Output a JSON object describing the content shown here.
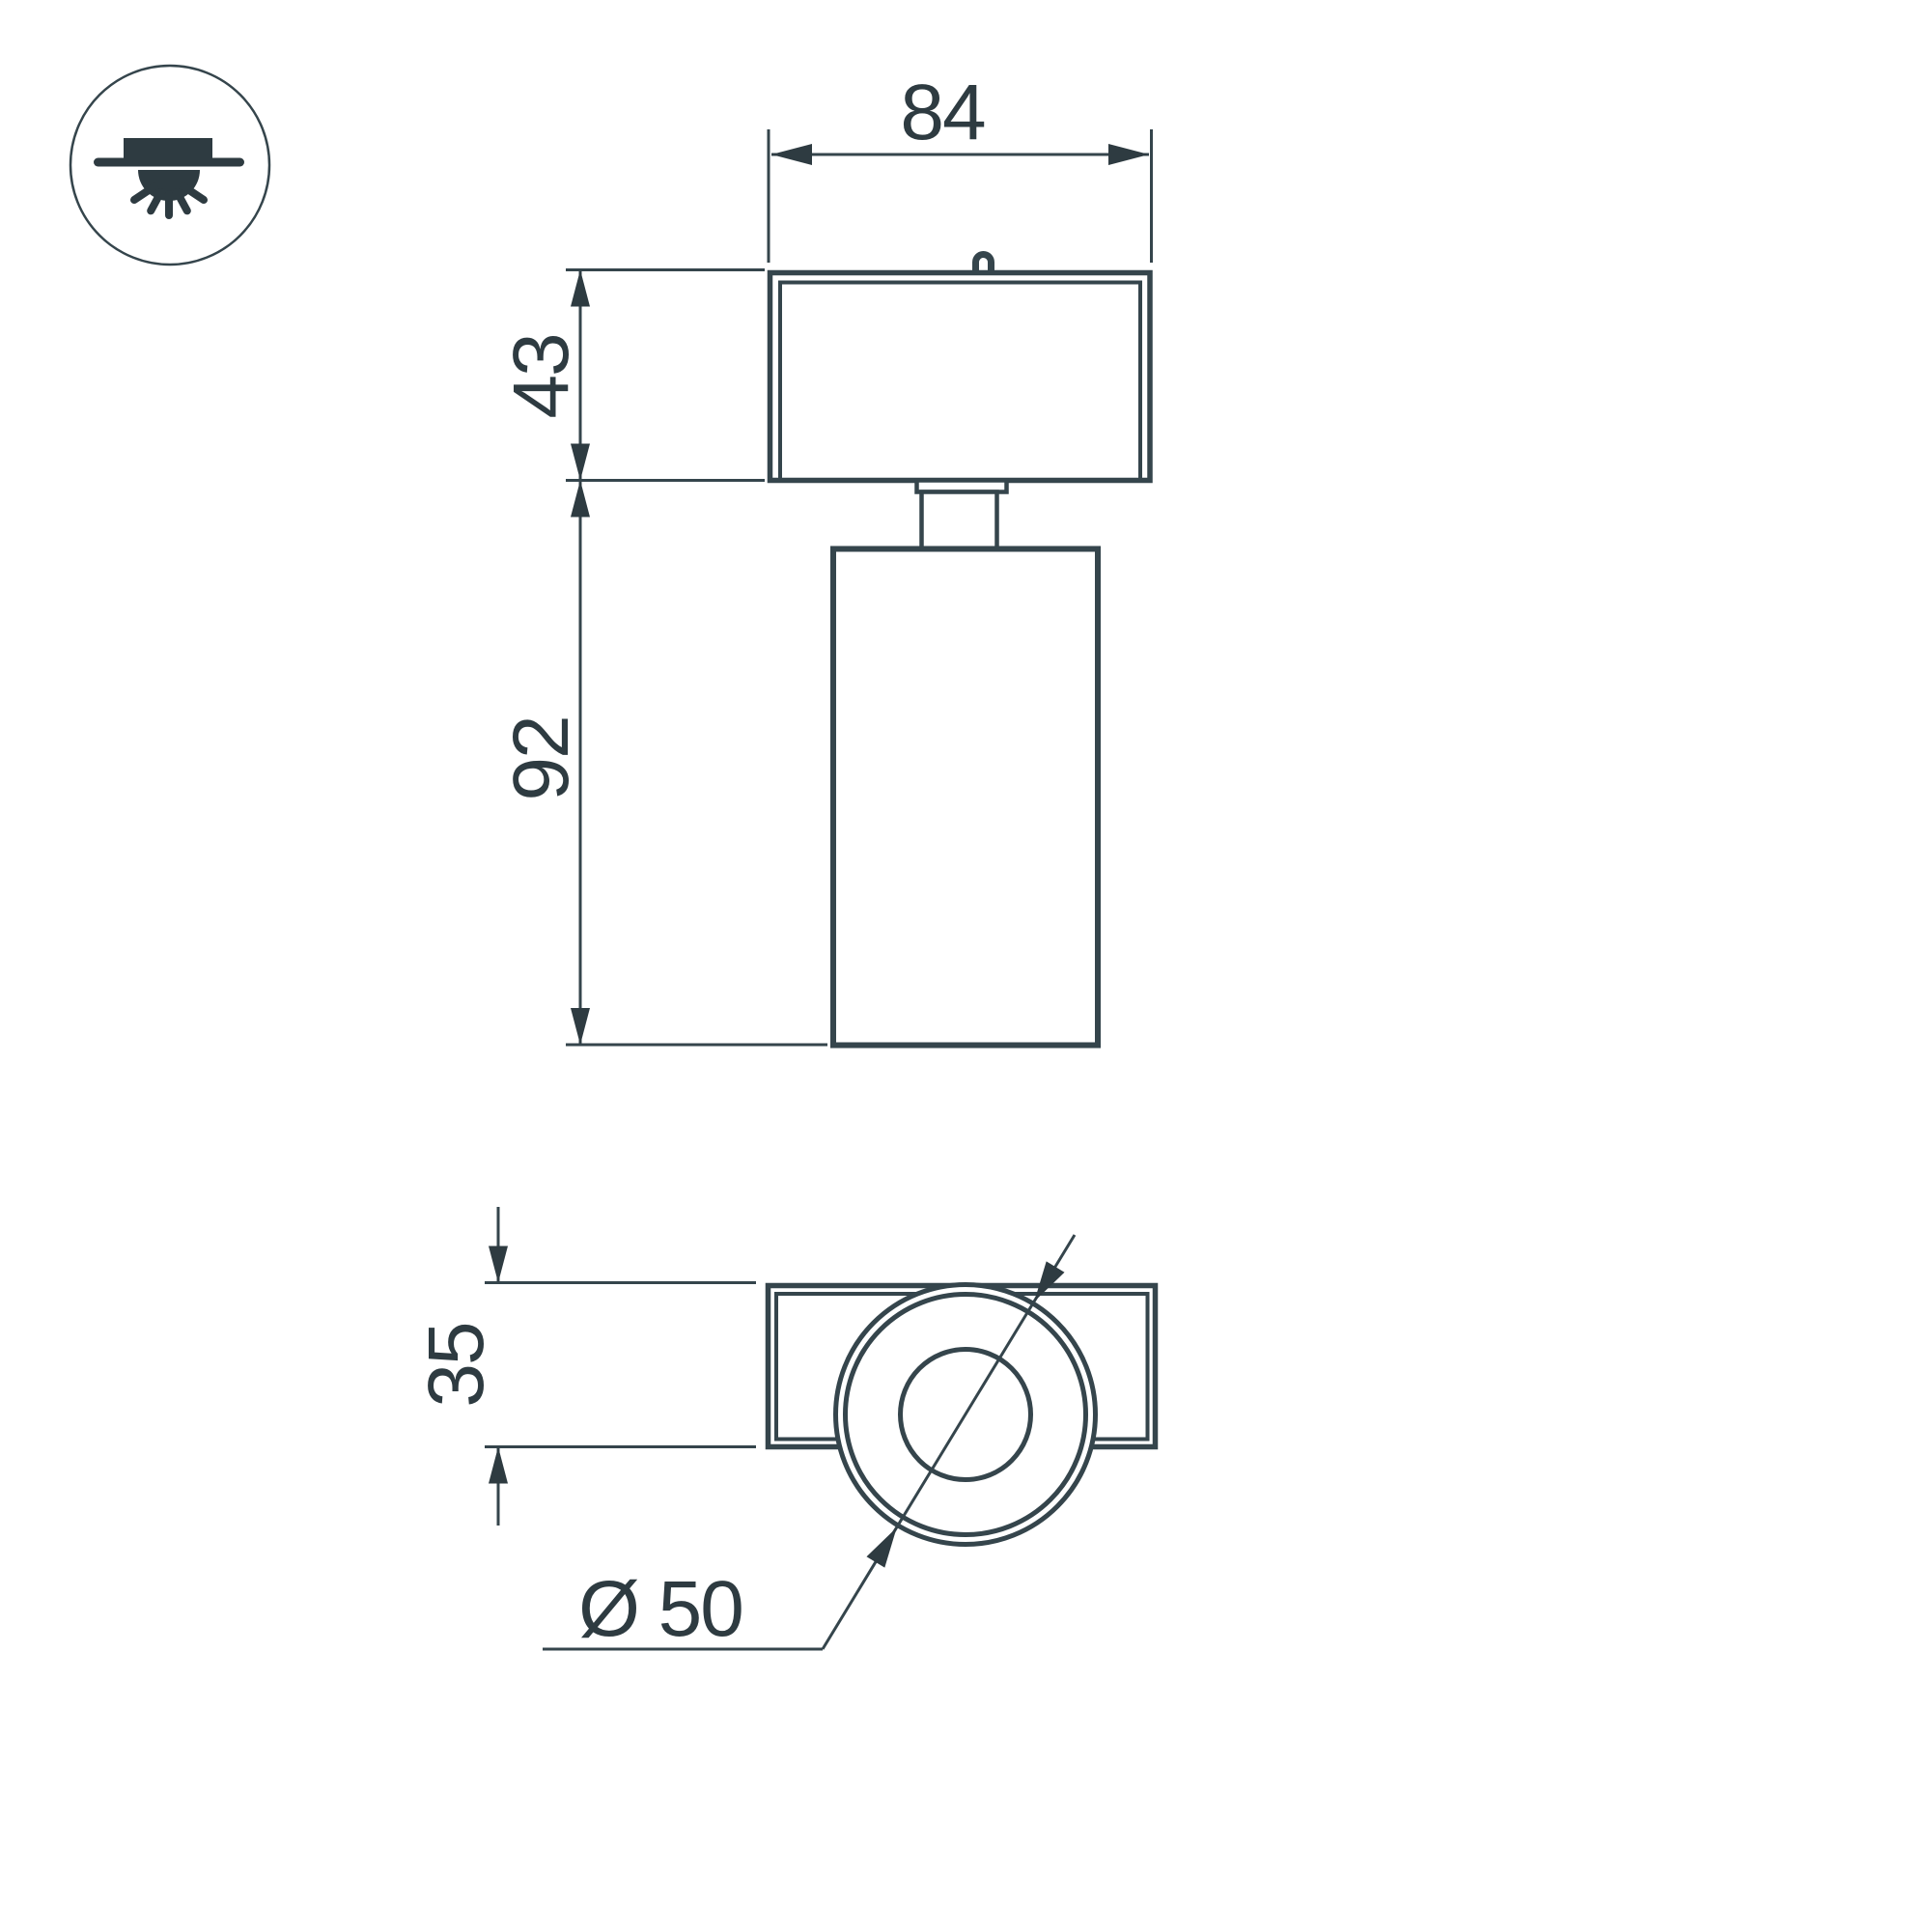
{
  "colors": {
    "line": "#35454c",
    "ink": "#2e3b41",
    "background": "#ffffff"
  },
  "icon": {
    "name": "surface-mounted-ceiling-light"
  },
  "dimensions": {
    "front_width": "84",
    "front_base_height": "43",
    "front_body_height": "92",
    "bottom_plate_height": "35",
    "face_diameter": "Ø 50"
  }
}
